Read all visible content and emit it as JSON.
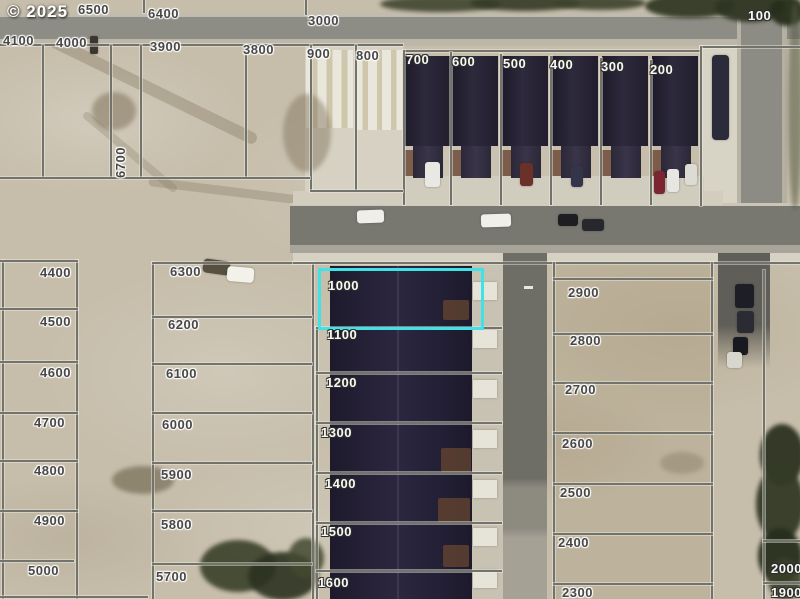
{
  "watermark": "© 2025",
  "map": {
    "type": "satellite-parcel-map",
    "highlight": {
      "parcel": "1000",
      "color": "#3fe2e6"
    },
    "label_colors": {
      "dark": "#474747",
      "light": "#f8f8f5"
    },
    "labels": [
      {
        "t": "6500",
        "x": 78,
        "y": 3,
        "s": "dark"
      },
      {
        "t": "6400",
        "x": 148,
        "y": 7,
        "s": "dark"
      },
      {
        "t": "3000",
        "x": 308,
        "y": 14,
        "s": "dark"
      },
      {
        "t": "100",
        "x": 748,
        "y": 9,
        "s": "light"
      },
      {
        "t": "4100",
        "x": 3,
        "y": 34,
        "s": "dark"
      },
      {
        "t": "4000",
        "x": 56,
        "y": 36,
        "s": "dark"
      },
      {
        "t": "3900",
        "x": 150,
        "y": 40,
        "s": "dark"
      },
      {
        "t": "3800",
        "x": 243,
        "y": 43,
        "s": "dark"
      },
      {
        "t": "900",
        "x": 307,
        "y": 47,
        "s": "dark"
      },
      {
        "t": "800",
        "x": 356,
        "y": 49,
        "s": "dark"
      },
      {
        "t": "700",
        "x": 406,
        "y": 53,
        "s": "light"
      },
      {
        "t": "600",
        "x": 452,
        "y": 55,
        "s": "light"
      },
      {
        "t": "500",
        "x": 503,
        "y": 57,
        "s": "light"
      },
      {
        "t": "400",
        "x": 550,
        "y": 58,
        "s": "light"
      },
      {
        "t": "300",
        "x": 601,
        "y": 60,
        "s": "light"
      },
      {
        "t": "200",
        "x": 650,
        "y": 63,
        "s": "light"
      },
      {
        "t": "6700",
        "x": 114,
        "y": 178,
        "s": "dark",
        "rot": true
      },
      {
        "t": "4400",
        "x": 40,
        "y": 266,
        "s": "dark"
      },
      {
        "t": "6300",
        "x": 170,
        "y": 265,
        "s": "dark"
      },
      {
        "t": "1000",
        "x": 328,
        "y": 279,
        "s": "light"
      },
      {
        "t": "2900",
        "x": 568,
        "y": 286,
        "s": "dark"
      },
      {
        "t": "4500",
        "x": 40,
        "y": 315,
        "s": "dark"
      },
      {
        "t": "6200",
        "x": 168,
        "y": 318,
        "s": "dark"
      },
      {
        "t": "1100",
        "x": 327,
        "y": 328,
        "s": "light"
      },
      {
        "t": "2800",
        "x": 570,
        "y": 334,
        "s": "dark"
      },
      {
        "t": "4600",
        "x": 40,
        "y": 366,
        "s": "dark"
      },
      {
        "t": "6100",
        "x": 166,
        "y": 367,
        "s": "dark"
      },
      {
        "t": "1200",
        "x": 326,
        "y": 376,
        "s": "light"
      },
      {
        "t": "2700",
        "x": 565,
        "y": 383,
        "s": "dark"
      },
      {
        "t": "4700",
        "x": 34,
        "y": 416,
        "s": "dark"
      },
      {
        "t": "6000",
        "x": 162,
        "y": 418,
        "s": "dark"
      },
      {
        "t": "1300",
        "x": 321,
        "y": 426,
        "s": "light"
      },
      {
        "t": "2600",
        "x": 562,
        "y": 437,
        "s": "dark"
      },
      {
        "t": "4800",
        "x": 34,
        "y": 464,
        "s": "dark"
      },
      {
        "t": "5900",
        "x": 161,
        "y": 468,
        "s": "dark"
      },
      {
        "t": "1400",
        "x": 325,
        "y": 477,
        "s": "light"
      },
      {
        "t": "2500",
        "x": 560,
        "y": 486,
        "s": "dark"
      },
      {
        "t": "4900",
        "x": 34,
        "y": 514,
        "s": "dark"
      },
      {
        "t": "5800",
        "x": 161,
        "y": 518,
        "s": "dark"
      },
      {
        "t": "1500",
        "x": 321,
        "y": 525,
        "s": "light"
      },
      {
        "t": "2400",
        "x": 558,
        "y": 536,
        "s": "dark"
      },
      {
        "t": "5000",
        "x": 28,
        "y": 564,
        "s": "dark"
      },
      {
        "t": "5700",
        "x": 156,
        "y": 570,
        "s": "dark"
      },
      {
        "t": "1600",
        "x": 318,
        "y": 576,
        "s": "light"
      },
      {
        "t": "2300",
        "x": 562,
        "y": 586,
        "s": "dark"
      },
      {
        "t": "2000",
        "x": 771,
        "y": 562,
        "s": "light"
      },
      {
        "t": "1900",
        "x": 771,
        "y": 586,
        "s": "light"
      }
    ]
  }
}
